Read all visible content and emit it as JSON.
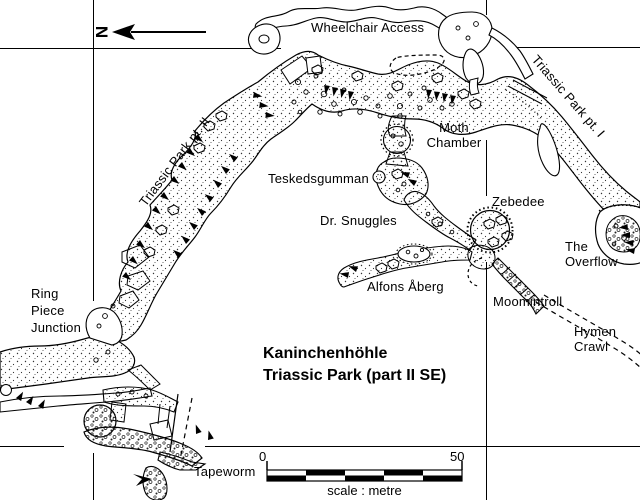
{
  "map": {
    "north_label": "N",
    "title": {
      "line1": "Kaninchenhöhle",
      "line2": "Triassic Park (part II SE)"
    },
    "scale_bar": {
      "start_value": "0",
      "end_value": "50",
      "caption": "scale : metre"
    },
    "labels": {
      "wheelchair_access": "Wheelchair Access",
      "triassic_park_pt2": "Triassic Park pt. II",
      "triassic_park_pt1": "Triassic Park pt. I",
      "moth_chamber": "Moth Chamber",
      "teskedsgumman": "Teskedsgumman",
      "dr_snuggles": "Dr. Snuggles",
      "zebedee": "Zebedee",
      "the_overflow": "The Overflow",
      "moomintroll": "Moomintroll",
      "alfons_aberg": "Alfons Åberg",
      "hymen_crawl": "Hymen Crawl",
      "ring_piece_junction": "Ring Piece Junction",
      "tapeworm": "Tapeworm"
    },
    "colors": {
      "ink": "#000000",
      "paper": "#ffffff"
    }
  }
}
